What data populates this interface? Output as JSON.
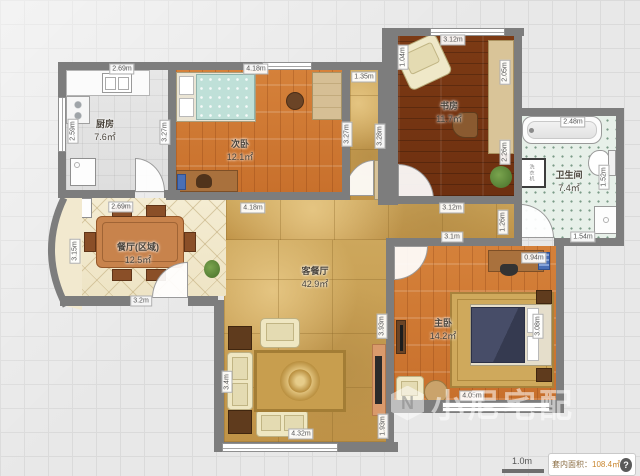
{
  "rooms": [
    {
      "id": "kitchen",
      "name": "厨房",
      "area": "7.6㎡",
      "x": 105,
      "y": 130
    },
    {
      "id": "bedroom-2",
      "name": "次卧",
      "area": "12.1㎡",
      "x": 240,
      "y": 150
    },
    {
      "id": "study",
      "name": "书房",
      "area": "11.7㎡",
      "x": 449,
      "y": 112
    },
    {
      "id": "bathroom",
      "name": "卫生间",
      "area": "7.4㎡",
      "x": 569,
      "y": 181
    },
    {
      "id": "dining-area",
      "name": "餐厅(区域)",
      "area": "12.5㎡",
      "x": 138,
      "y": 253
    },
    {
      "id": "living-dining",
      "name": "客餐厅",
      "area": "42.9㎡",
      "x": 315,
      "y": 277
    },
    {
      "id": "master-bedroom",
      "name": "主卧",
      "area": "14.2㎡",
      "x": 443,
      "y": 329
    }
  ],
  "dimensions": [
    {
      "t": "2.69m",
      "x": 122,
      "y": 69
    },
    {
      "t": "4.18m",
      "x": 256,
      "y": 69
    },
    {
      "t": "3.12m",
      "x": 453,
      "y": 40
    },
    {
      "t": "1.35m",
      "x": 364,
      "y": 77
    },
    {
      "t": "1.04m",
      "x": 403,
      "y": 57,
      "v": true
    },
    {
      "t": "2.05m",
      "x": 505,
      "y": 72,
      "v": true
    },
    {
      "t": "2.48m",
      "x": 573,
      "y": 122
    },
    {
      "t": "2.59m",
      "x": 73,
      "y": 131,
      "v": true
    },
    {
      "t": "3.27m",
      "x": 165,
      "y": 132,
      "v": true
    },
    {
      "t": "3.27m",
      "x": 347,
      "y": 134,
      "v": true
    },
    {
      "t": "3.28m",
      "x": 380,
      "y": 136,
      "v": true
    },
    {
      "t": "2.26m",
      "x": 505,
      "y": 152,
      "v": true
    },
    {
      "t": "1.52m",
      "x": 604,
      "y": 177,
      "v": true
    },
    {
      "t": "2.69m",
      "x": 121,
      "y": 207
    },
    {
      "t": "4.18m",
      "x": 253,
      "y": 208
    },
    {
      "t": "3.12m",
      "x": 452,
      "y": 208
    },
    {
      "t": "3.1m",
      "x": 452,
      "y": 237
    },
    {
      "t": "1.26m",
      "x": 503,
      "y": 222,
      "v": true
    },
    {
      "t": "0.94m",
      "x": 534,
      "y": 258
    },
    {
      "t": "1.54m",
      "x": 583,
      "y": 237
    },
    {
      "t": "3.15m",
      "x": 75,
      "y": 251,
      "v": true
    },
    {
      "t": "3.2m",
      "x": 141,
      "y": 301
    },
    {
      "t": "3.93m",
      "x": 382,
      "y": 326,
      "v": true
    },
    {
      "t": "3.08m",
      "x": 538,
      "y": 326,
      "v": true
    },
    {
      "t": "3.4m",
      "x": 227,
      "y": 382,
      "v": true
    },
    {
      "t": "1.93m",
      "x": 383,
      "y": 426,
      "v": true
    },
    {
      "t": "4.05m",
      "x": 472,
      "y": 396
    },
    {
      "t": "4.32m",
      "x": 301,
      "y": 434
    }
  ],
  "fixtures": {
    "washer": "洗衣机"
  },
  "watermark": {
    "logo": "N",
    "text": "小尼宅配"
  },
  "status_bar": {
    "scale": "1.0m",
    "area_label": "套内面积：",
    "area_value": "108.4㎡",
    "help": "?"
  },
  "colors": {
    "wall": "#7d7d7d",
    "wood_orange": "#d5813a",
    "wood_dark": "#7c3a14",
    "marble": "#c9a050",
    "mint_tile": "#e7f0e9",
    "cream_tile": "#f4ecd2"
  }
}
